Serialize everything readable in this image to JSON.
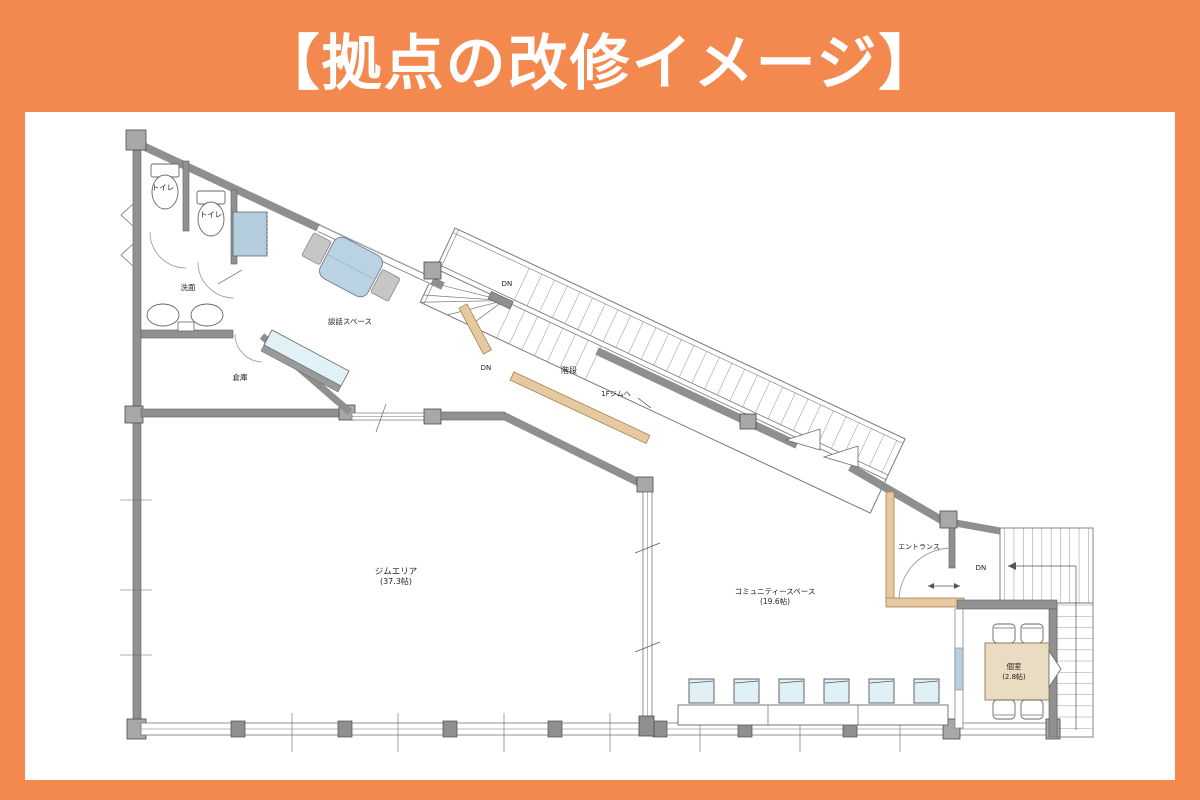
{
  "page": {
    "background_color": "#F3894E",
    "panel_color": "#FFFFFF"
  },
  "header": {
    "title": "【拠点の改修イメージ】",
    "text_color": "#FFFFFF"
  },
  "floor_plan": {
    "labels": {
      "toilet_1": "トイレ",
      "toilet_2": "トイレ",
      "washroom": "洗面",
      "storage": "倉庫",
      "lounge": "談話スペース",
      "stairs": "階段",
      "to_gym": "1Fジムへ",
      "dn": "DN",
      "gym": "ジムエリア",
      "gym_area": "(37.3帖)",
      "community": "コミュニティースペース",
      "community_area": "(19.6帖)",
      "entrance": "エントランス",
      "private_room": "個室",
      "private_room_area": "(2.8帖)"
    },
    "colors": {
      "wall_gray": "#919191",
      "wall_dark": "#5e5e5e",
      "post_gray": "#a8a8a8",
      "beige_wall": "#e7c9a1",
      "furniture_blue": "#b9d3e3",
      "cabinet_blue": "#b5cede",
      "glass_blue": "#dff0f6",
      "chair_gray": "#c6c6c6",
      "table_beige": "#e9dcc0",
      "line": "#555555"
    }
  }
}
